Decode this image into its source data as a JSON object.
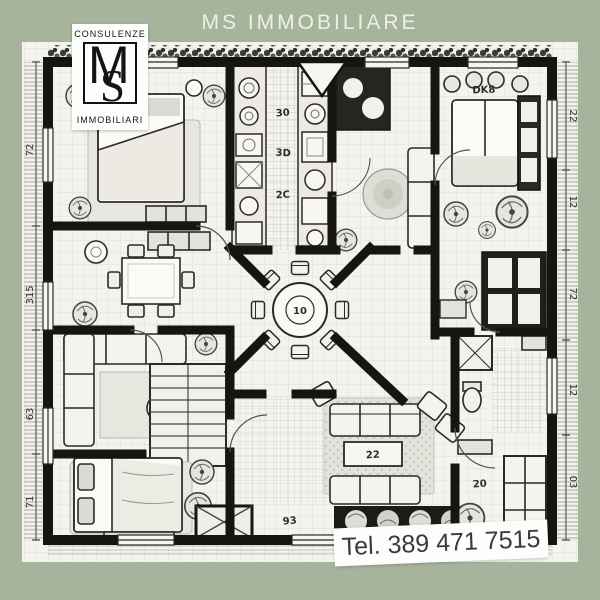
{
  "title": "MS IMMOBILIARE",
  "logo": {
    "top": "CONSULENZE",
    "monogram_m": "M",
    "monogram_s": "S",
    "bottom": "IMMOBILIARI"
  },
  "contact": {
    "phone": "Tel. 389 471 7515"
  },
  "colors": {
    "background": "#a6b49c",
    "paper": "#f4f3ee",
    "wall": "#171512",
    "title_text": "#edf1e3",
    "label_ink": "#3a3a38"
  },
  "plan": {
    "labels": {
      "kitchen_a": "30",
      "kitchen_b": "3D",
      "kitchen_c": "2C",
      "bedroom_right": "DK8",
      "dining_table": "10",
      "coffee_table": "22",
      "bathroom": "20",
      "entry": "93"
    },
    "dimensions": {
      "left": [
        "72",
        "315",
        "63",
        "71"
      ],
      "right": [
        "22",
        "12",
        "72",
        "12",
        "03"
      ]
    }
  }
}
